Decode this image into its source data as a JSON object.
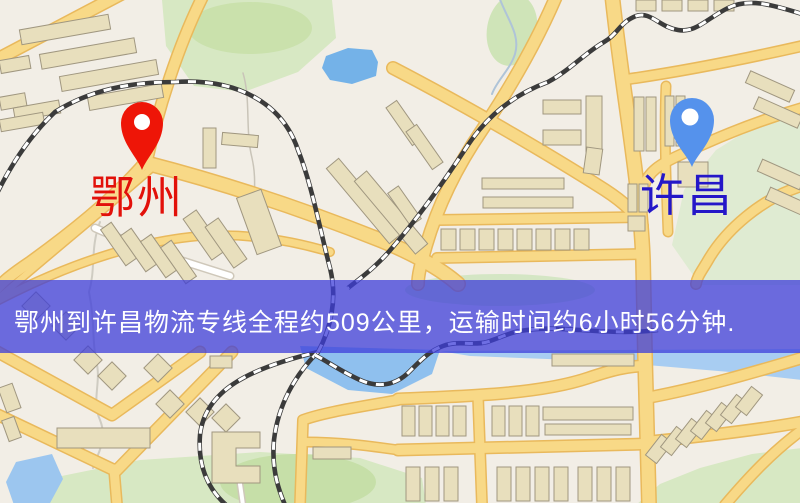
{
  "page": {
    "width": 800,
    "height": 503,
    "kind": "logistics-route-map"
  },
  "banner": {
    "text": "鄂州到许昌物流专线全程约509公里，运输时间约6小时56分钟.",
    "bg_rgba": "rgba(61,62,217,0.75)",
    "text_color": "#ffffff"
  },
  "markers": [
    {
      "role": "origin",
      "label": "鄂州",
      "pin_color": "#ee1507",
      "hole_color": "#ffffff",
      "label_color": "#e2110a",
      "label_x": 90,
      "label_y": 176
    },
    {
      "role": "destination",
      "label": "许昌",
      "pin_color": "#5592ec",
      "hole_color": "#ffffff",
      "label_color": "#2417c8",
      "label_x": 640,
      "label_y": 174
    }
  ],
  "map": {
    "bg": "#f2eee6",
    "palette": {
      "road_fill": "#f8d987",
      "road_casing": "#e9b95c",
      "white_road_fill": "#ffffff",
      "white_road_casing": "#cfc8ba",
      "building_fill": "#e8dfbd",
      "building_stroke": "#a09780",
      "rail_dark": "#3b3b3b",
      "rail_light": "#ffffff"
    },
    "greens": [
      {
        "kind": "poly",
        "points": "162,0 332,0 336,38 298,72 244,92 194,86 166,46",
        "fill": "#d7e8c3"
      },
      {
        "kind": "ellipse",
        "cx": 250,
        "cy": 28,
        "rx": 62,
        "ry": 26,
        "fill": "#cae1ac"
      },
      {
        "kind": "poly",
        "points": "802,115 802,285 700,285 672,245 684,190 716,150 758,124",
        "fill": "#dfebd2"
      },
      {
        "kind": "ellipse",
        "cx": 512,
        "cy": 30,
        "rx": 25,
        "ry": 36,
        "rot": 10,
        "fill": "#cfe4b8"
      },
      {
        "kind": "ellipse",
        "cx": 500,
        "cy": 290,
        "rx": 95,
        "ry": 16,
        "fill": "#d4e6c4"
      },
      {
        "kind": "poly",
        "points": "42,480 140,460 260,452 360,458 422,478 426,505 38,505",
        "fill": "#d7e8c3"
      },
      {
        "kind": "ellipse",
        "cx": 298,
        "cy": 482,
        "rx": 78,
        "ry": 28,
        "fill": "#c6dfa8"
      },
      {
        "kind": "poly",
        "points": "802,448 802,505 636,505 660,484 700,468 752,454",
        "fill": "#d7e8c3"
      }
    ],
    "waters": [
      {
        "kind": "poly",
        "points": "326,56 348,48 372,50 378,62 376,76 352,84 330,80 322,68",
        "fill": "#74b2e8"
      },
      {
        "kind": "poly",
        "points": "300,346 440,350 432,374 392,394 348,390 306,368",
        "fill": "#8fc0ee"
      },
      {
        "kind": "poly",
        "points": "440,351 802,349 802,380 730,372 600,361 470,356",
        "fill": "#a8cdf2"
      },
      {
        "kind": "poly",
        "points": "16,462 52,454 63,479 49,505 14,505 6,482",
        "fill": "#9cc6ef"
      }
    ],
    "streams": [
      {
        "d": "M243,73 C251,100 245,130 252,158 C258,184 251,204 257,226",
        "stroke": "#c9c4b8",
        "w": 1.5
      },
      {
        "d": "M498,-6 C506,18 521,34 515,54 C510,70 497,80 492,94",
        "stroke": "#afc4d8",
        "w": 2
      },
      {
        "d": "M100,222 C90,248 96,268 89,292 C95,322 92,340 96,360 C102,382 91,400 100,420 C108,440 98,452 93,468",
        "stroke": "#cfccc2",
        "w": 2
      }
    ],
    "roads": [
      {
        "d": "M-8,62 L125,-8",
        "w": 11,
        "type": "yellow"
      },
      {
        "d": "M205,-8 C178,45 158,110 147,160 C120,192 80,226 30,262 C12,274 2,282 -8,294",
        "w": 10,
        "type": "yellow"
      },
      {
        "d": "M152,168 C110,205 60,245 -6,302",
        "w": 6,
        "type": "yellow"
      },
      {
        "d": "M-5,302 C60,268 130,242 200,236 C245,233 290,240 330,252",
        "w": 7,
        "type": "yellow"
      },
      {
        "d": "M146,163 C220,182 300,208 380,240 C410,252 440,268 458,284",
        "w": 13,
        "type": "yellow"
      },
      {
        "d": "M558,-8 C538,40 512,85 482,130 C458,165 438,205 426,246 C421,264 418,274 418,284",
        "w": 11,
        "type": "yellow"
      },
      {
        "d": "M612,-6 C622,90 640,180 643,260 L645,356 L649,505",
        "w": 13,
        "type": "yellow"
      },
      {
        "d": "M393,68 C470,108 550,155 605,190 C625,203 636,214 642,226",
        "w": 11,
        "type": "yellow"
      },
      {
        "d": "M802,46 C740,60 680,72 622,80",
        "w": 9,
        "type": "yellow"
      },
      {
        "d": "M802,108 C760,120 720,136 680,155 C660,164 648,172 644,186",
        "w": 9,
        "type": "yellow"
      },
      {
        "d": "M802,186 C762,198 725,230 707,262 C701,272 697,277 696,284",
        "w": 9,
        "type": "yellow"
      },
      {
        "d": "M666,86 C664,130 666,180 668,232",
        "w": 8,
        "type": "yellow"
      },
      {
        "d": "M437,220 L641,217",
        "w": 9,
        "type": "yellow"
      },
      {
        "d": "M437,258 L641,254",
        "w": 9,
        "type": "yellow"
      },
      {
        "d": "M398,399 C470,396 540,394 588,378 C612,370 628,366 644,366",
        "w": 10,
        "type": "yellow"
      },
      {
        "d": "M646,398 C700,388 755,372 802,358",
        "w": 10,
        "type": "yellow"
      },
      {
        "d": "M646,442 C706,436 758,430 802,422",
        "w": 10,
        "type": "yellow"
      },
      {
        "d": "M725,505 C748,478 772,452 802,430",
        "w": 9,
        "type": "yellow"
      },
      {
        "d": "M398,450 L644,444",
        "w": 10,
        "type": "yellow"
      },
      {
        "d": "M478,396 L482,505",
        "w": 9,
        "type": "yellow"
      },
      {
        "d": "M398,400 C360,407 325,412 303,420 L300,505",
        "w": 9,
        "type": "yellow"
      },
      {
        "d": "M305,442 C340,442 370,446 398,450",
        "w": 8,
        "type": "yellow"
      },
      {
        "d": "M-6,350 L112,415 L200,352",
        "w": 10,
        "type": "yellow"
      },
      {
        "d": "M-6,413 L116,471 L232,352",
        "w": 10,
        "type": "yellow"
      },
      {
        "d": "M114,469 L117,505",
        "w": 9,
        "type": "yellow"
      },
      {
        "d": "M95,228 C140,248 185,262 230,276",
        "w": 6,
        "type": "white"
      },
      {
        "d": "M240,484 L243,505",
        "w": 4,
        "type": "white"
      }
    ],
    "rails": [
      {
        "d": "M-10,208 C5,175 25,140 55,112 C90,90 130,82 175,82 C240,78 283,105 298,150 C312,185 320,230 330,268 C338,300 330,330 318,352 C250,368 205,390 200,435 C197,475 215,498 235,512"
      },
      {
        "d": "M318,352 C295,375 278,405 274,440 C271,472 280,494 288,512"
      },
      {
        "d": "M802,14 C770,4 748,-2 728,8 C706,19 696,33 678,30 C659,27 651,11 636,16 C620,22 618,34 604,42 C585,53 570,70 548,82 C515,94 488,115 468,145 C445,180 418,218 392,248 C377,266 362,277 348,288"
      },
      {
        "d": "M315,355 C330,363 342,372 360,380 C380,389 397,384 409,372 C420,361 429,351 443,346 C459,340 472,346 487,342 C500,338 508,333 520,331 C545,327 560,329 580,330 C610,332 634,333 658,330"
      }
    ],
    "buildings": [
      {
        "x": 20,
        "y": 22,
        "w": 90,
        "h": 15,
        "r": -10
      },
      {
        "x": 40,
        "y": 46,
        "w": 96,
        "h": 15,
        "r": -10
      },
      {
        "x": 60,
        "y": 68,
        "w": 98,
        "h": 15,
        "r": -10
      },
      {
        "x": 88,
        "y": 90,
        "w": 75,
        "h": 14,
        "r": -10
      },
      {
        "x": 0,
        "y": 58,
        "w": 30,
        "h": 13,
        "r": -10
      },
      {
        "x": 0,
        "y": 95,
        "w": 26,
        "h": 13,
        "r": -10
      },
      {
        "x": 14,
        "y": 104,
        "w": 46,
        "h": 13,
        "r": -10
      },
      {
        "x": 0,
        "y": 116,
        "w": 44,
        "h": 12,
        "r": -10
      },
      {
        "x": 112,
        "y": 222,
        "w": 13,
        "h": 44,
        "r": -35
      },
      {
        "x": 132,
        "y": 228,
        "w": 13,
        "h": 44,
        "r": -35
      },
      {
        "x": 152,
        "y": 234,
        "w": 13,
        "h": 44,
        "r": -35
      },
      {
        "x": 172,
        "y": 240,
        "w": 13,
        "h": 44,
        "r": -35
      },
      {
        "x": 196,
        "y": 210,
        "w": 16,
        "h": 50,
        "r": -35
      },
      {
        "x": 218,
        "y": 218,
        "w": 16,
        "h": 50,
        "r": -35
      },
      {
        "x": 246,
        "y": 192,
        "w": 26,
        "h": 60,
        "r": -20
      },
      {
        "x": 203,
        "y": 128,
        "w": 13,
        "h": 40,
        "r": 0
      },
      {
        "x": 222,
        "y": 134,
        "w": 36,
        "h": 12,
        "r": 5
      },
      {
        "x": 356,
        "y": 152,
        "w": 16,
        "h": 98,
        "r": -40
      },
      {
        "x": 383,
        "y": 165,
        "w": 16,
        "h": 95,
        "r": -40
      },
      {
        "x": 398,
        "y": 100,
        "w": 13,
        "h": 46,
        "r": -35
      },
      {
        "x": 418,
        "y": 124,
        "w": 13,
        "h": 46,
        "r": -35
      },
      {
        "x": 398,
        "y": 186,
        "w": 13,
        "h": 40,
        "r": -35
      },
      {
        "x": 543,
        "y": 100,
        "w": 38,
        "h": 14,
        "r": 0
      },
      {
        "x": 543,
        "y": 130,
        "w": 38,
        "h": 15,
        "r": 0
      },
      {
        "x": 586,
        "y": 96,
        "w": 16,
        "h": 56,
        "r": 0
      },
      {
        "x": 585,
        "y": 148,
        "w": 16,
        "h": 26,
        "r": 8
      },
      {
        "x": 634,
        "y": 97,
        "w": 10,
        "h": 54,
        "r": 0
      },
      {
        "x": 646,
        "y": 97,
        "w": 10,
        "h": 54,
        "r": 0
      },
      {
        "x": 665,
        "y": 96,
        "w": 9,
        "h": 50,
        "r": 0
      },
      {
        "x": 676,
        "y": 96,
        "w": 9,
        "h": 50,
        "r": 0
      },
      {
        "x": 678,
        "y": 162,
        "w": 30,
        "h": 25,
        "r": 0
      },
      {
        "x": 628,
        "y": 184,
        "w": 9,
        "h": 28,
        "r": 0
      },
      {
        "x": 639,
        "y": 184,
        "w": 9,
        "h": 28,
        "r": 0
      },
      {
        "x": 628,
        "y": 216,
        "w": 17,
        "h": 15,
        "r": 0
      },
      {
        "x": 482,
        "y": 178,
        "w": 82,
        "h": 11,
        "r": 0
      },
      {
        "x": 483,
        "y": 197,
        "w": 90,
        "h": 11,
        "r": 0
      },
      {
        "x": 441,
        "y": 229,
        "w": 15,
        "h": 21,
        "r": 0
      },
      {
        "x": 460,
        "y": 229,
        "w": 15,
        "h": 21,
        "r": 0
      },
      {
        "x": 479,
        "y": 229,
        "w": 15,
        "h": 21,
        "r": 0
      },
      {
        "x": 498,
        "y": 229,
        "w": 15,
        "h": 21,
        "r": 0
      },
      {
        "x": 517,
        "y": 229,
        "w": 15,
        "h": 21,
        "r": 0
      },
      {
        "x": 536,
        "y": 229,
        "w": 15,
        "h": 21,
        "r": 0
      },
      {
        "x": 555,
        "y": 229,
        "w": 15,
        "h": 21,
        "r": 0
      },
      {
        "x": 574,
        "y": 229,
        "w": 15,
        "h": 21,
        "r": 0
      },
      {
        "x": 636,
        "y": 0,
        "w": 20,
        "h": 11,
        "r": 0
      },
      {
        "x": 662,
        "y": 0,
        "w": 20,
        "h": 11,
        "r": 0
      },
      {
        "x": 688,
        "y": 0,
        "w": 20,
        "h": 11,
        "r": 0
      },
      {
        "x": 714,
        "y": 0,
        "w": 20,
        "h": 11,
        "r": 0
      },
      {
        "x": 746,
        "y": 80,
        "w": 48,
        "h": 13,
        "r": 24
      },
      {
        "x": 754,
        "y": 106,
        "w": 48,
        "h": 13,
        "r": 24
      },
      {
        "x": 758,
        "y": 168,
        "w": 46,
        "h": 13,
        "r": 24
      },
      {
        "x": 766,
        "y": 196,
        "w": 46,
        "h": 13,
        "r": 24
      },
      {
        "x": 210,
        "y": 356,
        "w": 22,
        "h": 12,
        "r": 0
      },
      {
        "x": 552,
        "y": 354,
        "w": 82,
        "h": 12,
        "r": 0
      },
      {
        "x": 26,
        "y": 296,
        "w": 20,
        "h": 20,
        "r": 45
      },
      {
        "x": 56,
        "y": 316,
        "w": 20,
        "h": 20,
        "r": 45
      },
      {
        "x": 78,
        "y": 350,
        "w": 20,
        "h": 20,
        "r": 45
      },
      {
        "x": 102,
        "y": 366,
        "w": 20,
        "h": 20,
        "r": 45
      },
      {
        "x": 148,
        "y": 358,
        "w": 20,
        "h": 20,
        "r": 45
      },
      {
        "x": 160,
        "y": 394,
        "w": 20,
        "h": 20,
        "r": 45
      },
      {
        "x": 190,
        "y": 402,
        "w": 20,
        "h": 20,
        "r": 45
      },
      {
        "x": 216,
        "y": 408,
        "w": 20,
        "h": 20,
        "r": 45
      },
      {
        "x": 2,
        "y": 385,
        "w": 15,
        "h": 26,
        "r": -20
      },
      {
        "x": 5,
        "y": 418,
        "w": 13,
        "h": 22,
        "r": -20
      },
      {
        "x": 57,
        "y": 428,
        "w": 93,
        "h": 20,
        "r": 0
      },
      {
        "kind": "poly",
        "points": "212,432 260,432 260,448 236,448 236,466 260,466 260,483 212,483"
      },
      {
        "x": 313,
        "y": 447,
        "w": 38,
        "h": 12,
        "r": 0
      },
      {
        "x": 402,
        "y": 406,
        "w": 13,
        "h": 30,
        "r": 0
      },
      {
        "x": 419,
        "y": 406,
        "w": 13,
        "h": 30,
        "r": 0
      },
      {
        "x": 436,
        "y": 406,
        "w": 13,
        "h": 30,
        "r": 0
      },
      {
        "x": 453,
        "y": 406,
        "w": 13,
        "h": 30,
        "r": 0
      },
      {
        "x": 492,
        "y": 406,
        "w": 13,
        "h": 30,
        "r": 0
      },
      {
        "x": 509,
        "y": 406,
        "w": 13,
        "h": 30,
        "r": 0
      },
      {
        "x": 526,
        "y": 406,
        "w": 13,
        "h": 30,
        "r": 0
      },
      {
        "x": 543,
        "y": 407,
        "w": 90,
        "h": 13,
        "r": 0
      },
      {
        "x": 545,
        "y": 424,
        "w": 86,
        "h": 11,
        "r": 0
      },
      {
        "x": 406,
        "y": 467,
        "w": 14,
        "h": 34,
        "r": 0
      },
      {
        "x": 425,
        "y": 467,
        "w": 14,
        "h": 34,
        "r": 0
      },
      {
        "x": 444,
        "y": 467,
        "w": 14,
        "h": 34,
        "r": 0
      },
      {
        "x": 497,
        "y": 467,
        "w": 14,
        "h": 34,
        "r": 0
      },
      {
        "x": 516,
        "y": 467,
        "w": 14,
        "h": 34,
        "r": 0
      },
      {
        "x": 535,
        "y": 467,
        "w": 14,
        "h": 34,
        "r": 0
      },
      {
        "x": 554,
        "y": 467,
        "w": 14,
        "h": 34,
        "r": 0
      },
      {
        "x": 578,
        "y": 467,
        "w": 14,
        "h": 34,
        "r": 0
      },
      {
        "x": 597,
        "y": 467,
        "w": 14,
        "h": 34,
        "r": 0
      },
      {
        "x": 616,
        "y": 467,
        "w": 14,
        "h": 34,
        "r": 0
      },
      {
        "x": 652,
        "y": 436,
        "w": 14,
        "h": 26,
        "r": 38
      },
      {
        "x": 667,
        "y": 428,
        "w": 14,
        "h": 26,
        "r": 38
      },
      {
        "x": 682,
        "y": 420,
        "w": 14,
        "h": 26,
        "r": 38
      },
      {
        "x": 697,
        "y": 412,
        "w": 14,
        "h": 26,
        "r": 38
      },
      {
        "x": 712,
        "y": 404,
        "w": 14,
        "h": 26,
        "r": 38
      },
      {
        "x": 727,
        "y": 396,
        "w": 14,
        "h": 26,
        "r": 38
      },
      {
        "x": 742,
        "y": 388,
        "w": 14,
        "h": 26,
        "r": 38
      }
    ]
  }
}
